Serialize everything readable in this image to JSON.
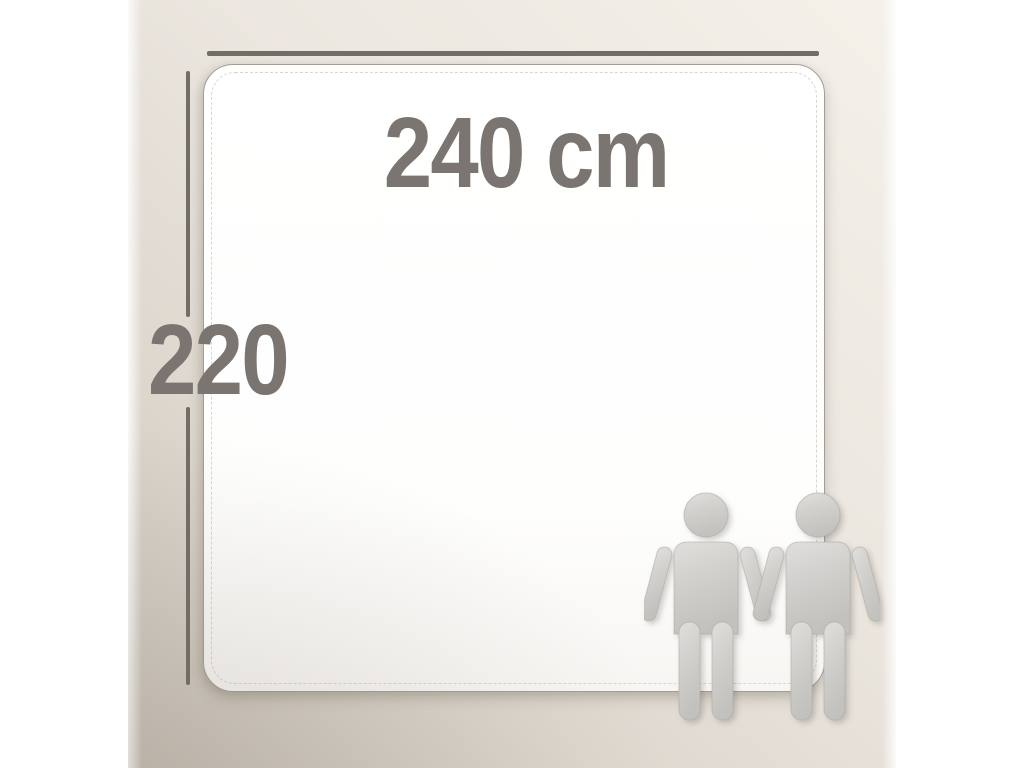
{
  "diagram": {
    "width_label": "240 cm",
    "height_label": "220",
    "scale_figures": [
      "person",
      "person"
    ],
    "colors": {
      "label_color": "#7a7571",
      "dimension_line_color": "#716d67",
      "sheet_fill": "#ffffff",
      "sheet_border": "#a39d96",
      "stitch_color": "#d9d5cf",
      "background_light": "#f4f1ea",
      "background_dark": "#c8c1b7",
      "figure_fill": "#d1d0cd"
    }
  }
}
